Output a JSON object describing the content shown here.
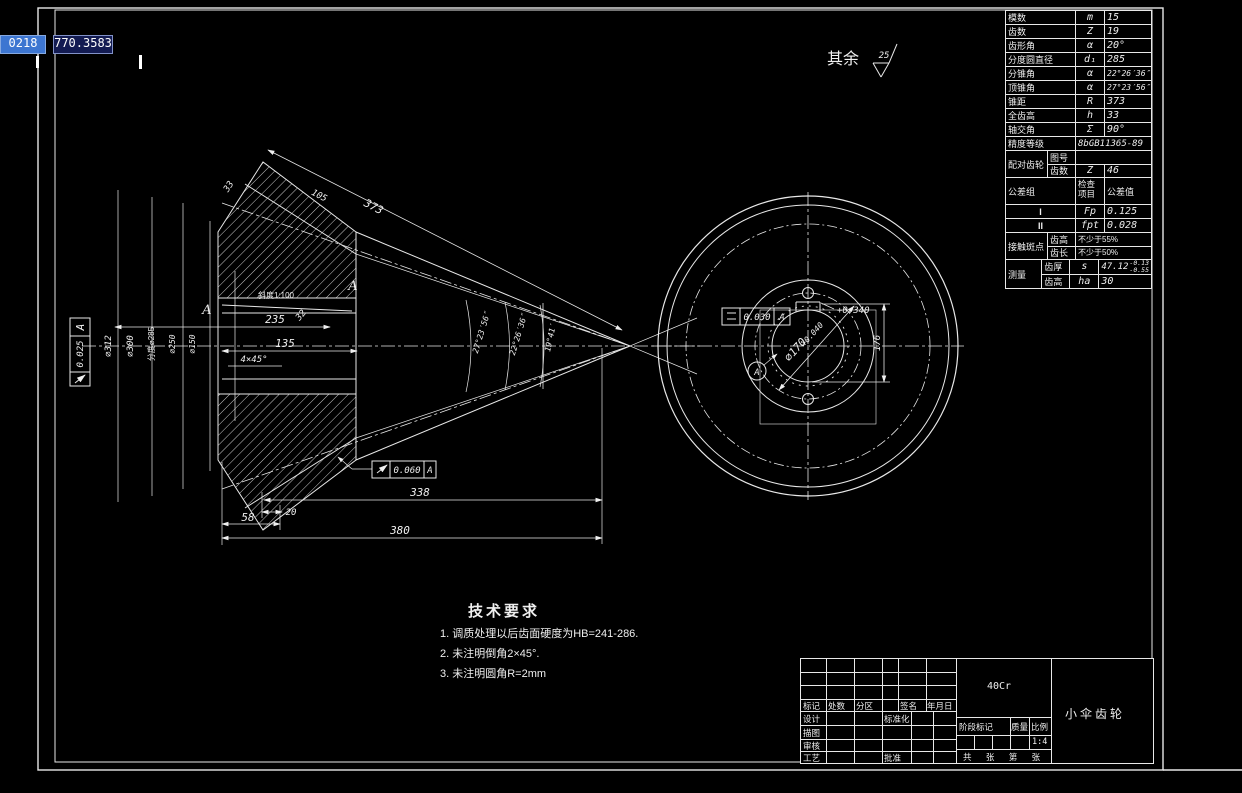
{
  "coords": {
    "x": "0218",
    "y": "770.3583"
  },
  "surface": {
    "prefix": "其余",
    "roughness": "25"
  },
  "param_table": {
    "rows": [
      {
        "label": "模数",
        "sym": "m",
        "val": "15"
      },
      {
        "label": "齿数",
        "sym": "Z",
        "val": "19"
      },
      {
        "label": "齿形角",
        "sym": "α",
        "val": "20°"
      },
      {
        "label": "分度圆直径",
        "sym": "d₁",
        "val": "285"
      },
      {
        "label": "分锥角",
        "sym": "α",
        "val": "22°26′36″"
      },
      {
        "label": "顶锥角",
        "sym": "α",
        "val": "27°23′56″"
      },
      {
        "label": "锥距",
        "sym": "R",
        "val": "373"
      },
      {
        "label": "全齿高",
        "sym": "h",
        "val": "33"
      },
      {
        "label": "轴交角",
        "sym": "Σ",
        "val": "90°"
      }
    ],
    "accuracy": {
      "label": "精度等级",
      "val": "8bGB11365-89"
    },
    "mating": {
      "label": "配对齿轮",
      "row1_key": "图号",
      "row1_val": "",
      "row2_key": "齿数",
      "row2_sym": "Z",
      "row2_val": "46"
    },
    "tol_header": {
      "group": "公差组",
      "item": "检查项目",
      "value": "公差值"
    },
    "tol_rows": [
      {
        "group": "I",
        "item": "Fp",
        "val": "0.125"
      },
      {
        "group": "II",
        "item": "fpt",
        "val": "0.028"
      }
    ],
    "contact": {
      "label": "接触斑点",
      "row1_key": "齿高",
      "row1_val": "不少于55%",
      "row2_key": "齿长",
      "row2_val": "不少于50%"
    },
    "measure": {
      "label": "测量",
      "row1_key": "齿厚",
      "row1_sym": "s",
      "row1_val": "47.12",
      "row1_sup": "-0.13",
      "row1_sub": "-0.55",
      "row2_key": "齿高",
      "row2_sym": "ha",
      "row2_val": "30"
    }
  },
  "dims": {
    "d312": "⌀312",
    "d300": "⌀300",
    "d285": "分度⌀285",
    "d250": "⌀250",
    "d150": "⌀150",
    "cone_dist": "373",
    "tooth_depth": "33",
    "face_width": "105",
    "ang_face": "27°23′56″",
    "ang_pitch": "22°26′36″",
    "ang_root": "19°41′",
    "hub_len": "235",
    "key_dim": "32",
    "bore_len": "135",
    "chamfer": "4×45°",
    "taper": "斜度1:100",
    "tip_apex": "338",
    "tip_w": "20",
    "back_w": "58",
    "total": "380",
    "section_a": "A"
  },
  "gdt": {
    "left_val": "0.025",
    "left_datum": "A",
    "bottom_val": "0.060",
    "bottom_datum": "A",
    "front_val": "0.030",
    "front_datum": "A"
  },
  "front": {
    "bore": "⌀170",
    "bore_tol": "+0.040",
    "key_tol": "+0.340",
    "key_depth": "176",
    "datum": "A"
  },
  "tech": {
    "title": "技术要求",
    "lines": [
      "1. 调质处理以后齿面硬度为HB=241-286.",
      "2. 未注明倒角2×45°.",
      "3. 未注明圆角R=2mm"
    ]
  },
  "title_block": {
    "material": "40Cr",
    "part_name": "小伞齿轮",
    "biaoji": "标记",
    "chushu": "处数",
    "fenqu": "分区",
    "qianming": "签名",
    "nianyueri": "年月日",
    "sheji": "设计",
    "biaozhunhua": "标准化",
    "miaotu": "描图",
    "shenhe": "审核",
    "gongyi": "工艺",
    "pizhun": "批准",
    "jieduan": "阶段标记",
    "zhiliang": "质量",
    "bili": "比例",
    "scale": "1:4",
    "sheets": "共 张 第 张"
  }
}
